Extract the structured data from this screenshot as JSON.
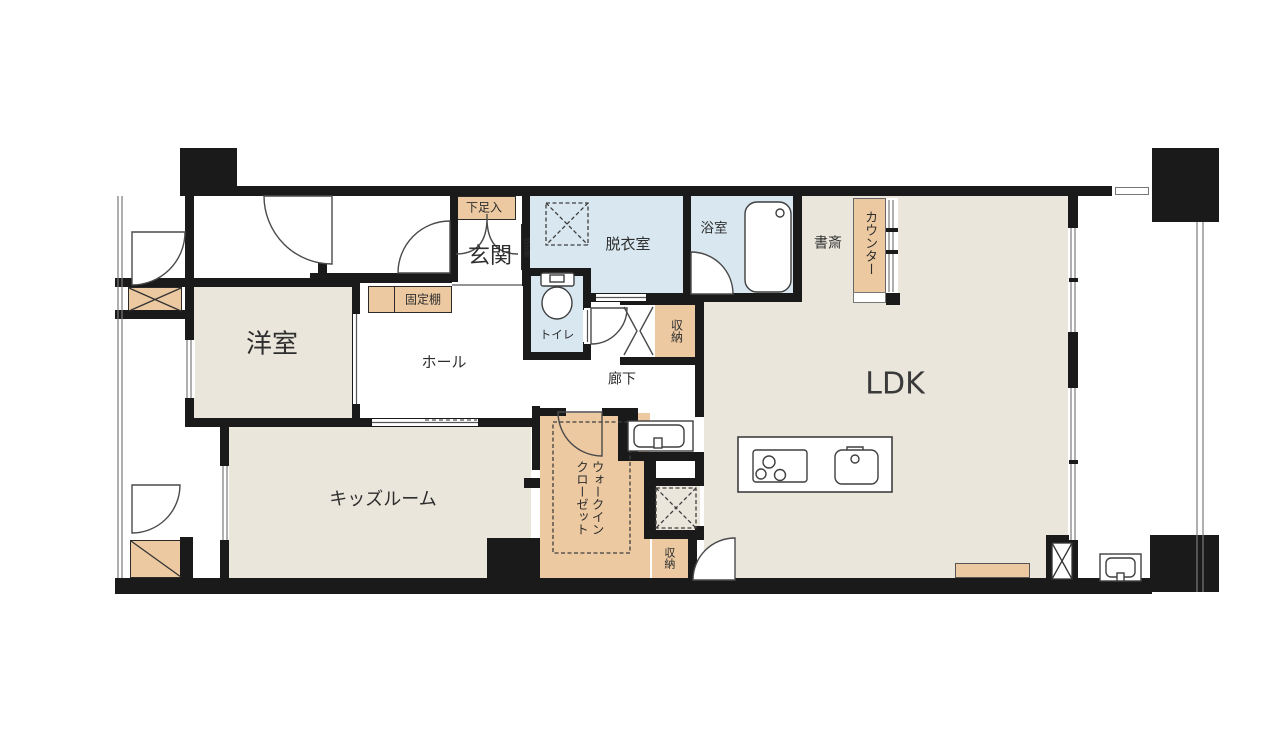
{
  "plan": {
    "labels": {
      "genkan": "玄関",
      "shoe_cabinet": "下足入",
      "fixed_shelf_entry": "固定棚",
      "dressing_room": "脱衣室",
      "bathroom": "浴室",
      "study": "書斎",
      "counter": "カウンター",
      "ldk": "LDK",
      "western_room": "洋室",
      "hall": "ホール",
      "fixed_shelf_hall": "固定棚",
      "toilet": "トイレ",
      "corridor": "廊下",
      "storage_upper": "収納",
      "storage_lower": "収納",
      "kids_room": "キッズルーム",
      "walk_in_closet": "ウォークイン\nクローゼット"
    },
    "colors": {
      "wall": "#1a1a1a",
      "room_floor": "#eae6dc",
      "storage_fill": "#ecc9a0",
      "wet_area_floor": "#d9e7f0",
      "outline": "#4a4a4a",
      "background": "#ffffff"
    }
  }
}
